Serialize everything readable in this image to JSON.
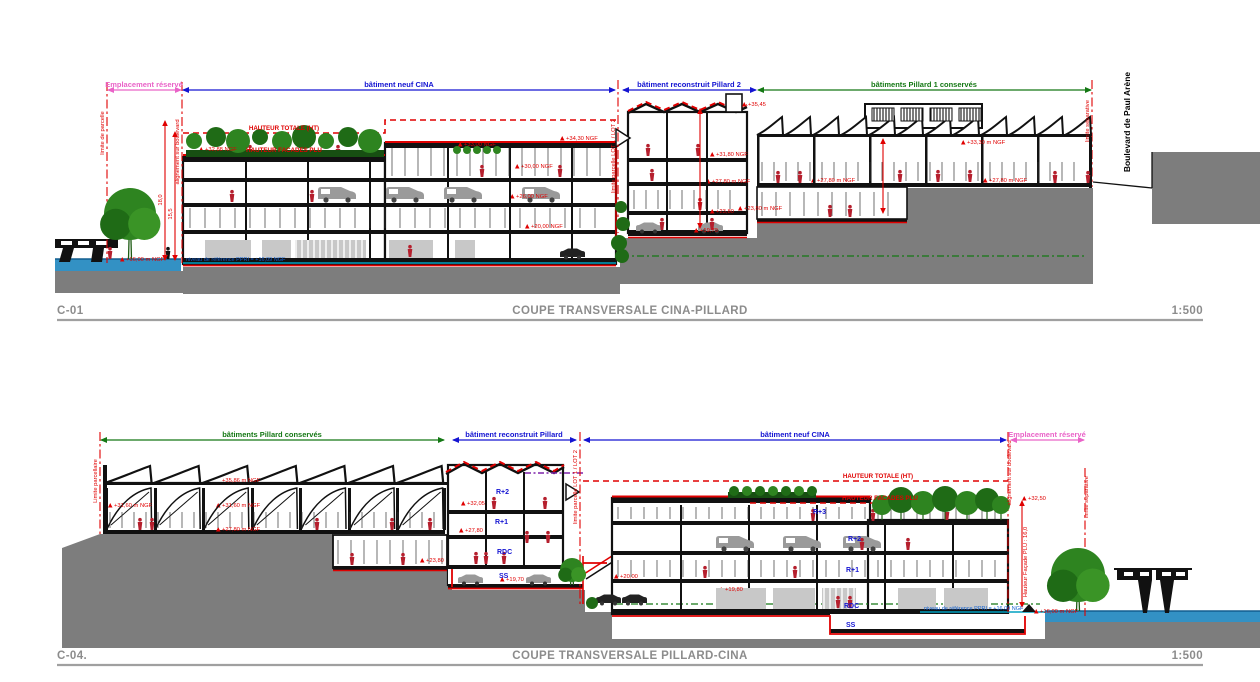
{
  "colors": {
    "annotation_red": "#e00000",
    "zone_blue": "#1414d2",
    "zone_green": "#147814",
    "zone_pink": "#ea63c8",
    "terrain_gray": "#7d7d7d",
    "water_blue": "#3391c4",
    "vegetation_green": "#2e8420",
    "figure_red": "#b51f2d",
    "title_gray": "#8c8c8c",
    "ppri_blue": "#1060d0"
  },
  "p1": {
    "id": "C-01",
    "title": "COUPE TRANSVERSALE CINA-PILLARD",
    "scale": "1:500",
    "zones": [
      "Emplacement réservé",
      "bâtiment neuf CINA",
      "bâtiment reconstruit Pillard 2",
      "bâtiments Pillard 1 conservés"
    ],
    "limits": [
      "limite de parcelle",
      "alignement sur boulevard",
      "limite parcelle LOT 1 / LOT 2",
      "limite séparative"
    ],
    "street": "Boulevard de Paul Arène",
    "hauteur": [
      "HAUTEUR TOTALE (HT)",
      "HAUTEUR FACADES PLU"
    ],
    "dims": [
      "18,0",
      "15,5"
    ],
    "levels": [
      "+32,88 NGF",
      "+33,00 NGF",
      "+34,30 NGF",
      "+30,00 NGF",
      "+26,00 NGF",
      "+20,00 NGF",
      "+16,00 m NGF",
      "+35,45",
      "+31,80 NGF",
      "+27,80 m NGF",
      "+23,80",
      "+19,70",
      "+33,30 m NGF",
      "+27,80 m NGF",
      "+27,80 m NGF",
      "+23,80 m NGF"
    ],
    "reference": "niveau de référence PPRI = +16,09 NGF"
  },
  "p2": {
    "id": "C-04.",
    "title": "COUPE TRANSVERSALE PILLARD-CINA",
    "scale": "1:500",
    "zones": [
      "bâtiments Pillard conservés",
      "bâtiment reconstruit Pillard",
      "bâtiment neuf CINA",
      "Emplacement réservé"
    ],
    "limits": [
      "Limite parcellaire",
      "limite parcelle LOT 1 / LOT 2",
      "alignement sur boulevard",
      "limite séparative"
    ],
    "hauteur": [
      "HAUTEUR TOTALE (HT)",
      "HAUTEUR FACADES PLU",
      "Hauteur Façade PLU : 16,0"
    ],
    "floors_pillard": [
      "R+2",
      "R+1",
      "RDC",
      "SS"
    ],
    "floors_cina": [
      "R+3",
      "R+2",
      "R+1",
      "RDC",
      "SS"
    ],
    "levels": [
      "+35,86 m NGF",
      "+31,60 m NGF",
      "+31,60 m NGF",
      "+27,80 m NGF",
      "+23,80",
      "+32,05",
      "+27,80",
      "+19,70",
      "+32,50",
      "+20,00",
      "+19,80",
      "+16,00 m NGF"
    ],
    "reference": "niveau de référence PPRI = +16,09 NGF"
  }
}
